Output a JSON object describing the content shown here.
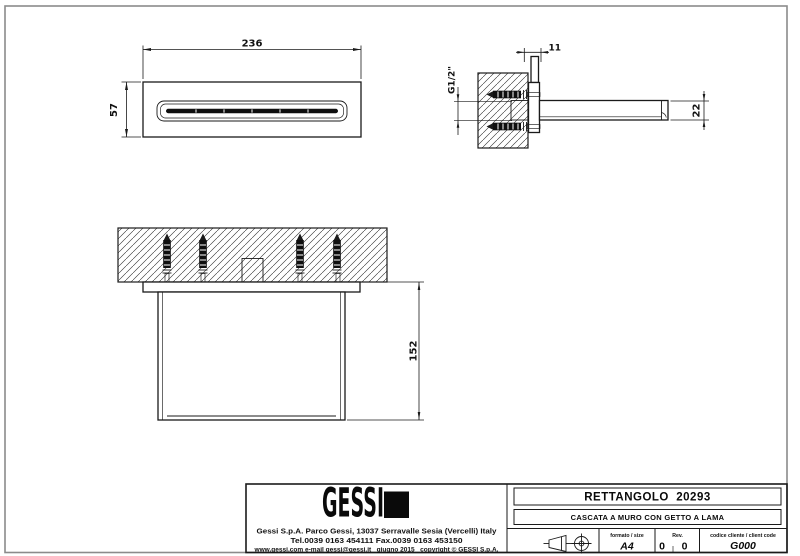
{
  "page": {
    "background": "#ffffff",
    "frame_color": "#8b8b8b",
    "line_color": "#1a1a1a"
  },
  "views": {
    "front": {
      "dim_width": "236",
      "dim_height": "57"
    },
    "side": {
      "dim_flange_depth": "11",
      "dim_thread": "G1/2\"",
      "dim_spout_height": "22"
    },
    "bottom": {
      "dim_projection": "152"
    }
  },
  "title_block": {
    "logo_text": "GESSI",
    "address_line1": "Gessi S.p.A. Parco Gessi, 13037 Serravalle Sesia (Vercelli) Italy",
    "address_line2": "Tel.0039 0163 454111 Fax.0039 0163 453150",
    "address_line3": "www.gessi.com e-mail gessi@gessi.it   giugno 2015   copyright © GESSI S.p.A.",
    "product_name": "RETTANGOLO  20293",
    "product_description": "CASCATA A MURO CON GETTO A LAMA",
    "format_label": "formato / size",
    "format_value": "A4",
    "rev_label": "Rev.",
    "rev_value_left": "0",
    "rev_value_right": "0",
    "client_code_label": "codice cliente / client code",
    "client_code_value": "G000"
  }
}
